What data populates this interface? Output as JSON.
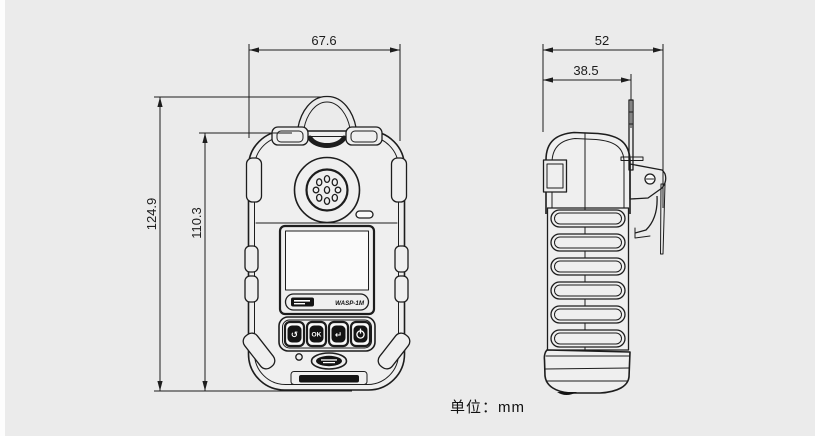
{
  "unit_note": "单位：mm",
  "dimensions": {
    "front_width_mm": "67.6",
    "total_height_mm": "124.9",
    "body_height_mm": "110.3",
    "total_depth_mm": "52",
    "body_depth_mm": "38.5"
  },
  "device": {
    "model_label": "WASP-1M",
    "buttons": {
      "mode_glyph": "↺",
      "ok_label": "OK",
      "back_glyph": "↵",
      "power_icon": "power"
    }
  }
}
